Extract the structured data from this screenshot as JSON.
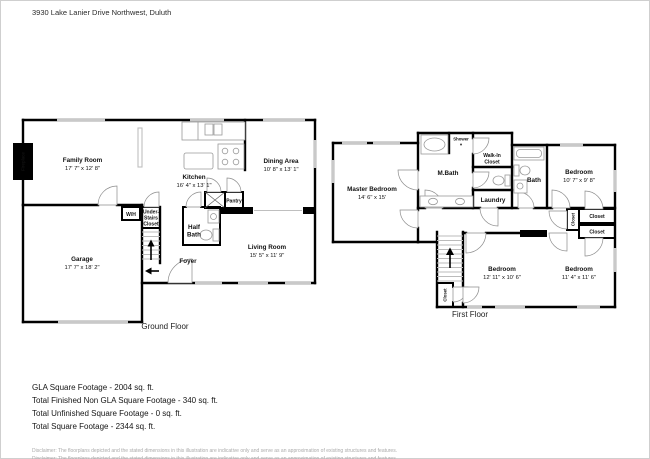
{
  "address": "3930 Lake Lanier Drive Northwest, Duluth",
  "ground_floor": {
    "caption": "Ground Floor",
    "family_room": {
      "name": "Family Room",
      "dims": "17' 7\" x 12' 8\""
    },
    "kitchen": {
      "name": "Kitchen",
      "dims": "16' 4\" x 13' 1\""
    },
    "dining_area": {
      "name": "Dining Area",
      "dims": "10' 8\" x 13' 1\""
    },
    "garage": {
      "name": "Garage",
      "dims": "17' 7\" x 18' 2\""
    },
    "living_room": {
      "name": "Living Room",
      "dims": "15' 5\" x 11' 9\""
    },
    "half_bath": {
      "line1": "Half",
      "line2": "Bath"
    },
    "foyer": "Foyer",
    "pantry": "Pantry",
    "wh": "W/H",
    "under_stairs_closet": {
      "line1": "Under-",
      "line2": "Stairs",
      "line3": "Closet"
    },
    "fireplace": "Fireplace"
  },
  "first_floor": {
    "caption": "First Floor",
    "master_bedroom": {
      "name": "Master Bedroom",
      "dims": "14' 6\" x 15'"
    },
    "m_bath": "M.Bath",
    "shower": "Shower",
    "walk_in_closet": {
      "line1": "Walk-In",
      "line2": "Closet"
    },
    "laundry": "Laundry",
    "bath": "Bath",
    "bedroom_top_right": {
      "name": "Bedroom",
      "dims": "10' 7\" x 9' 8\""
    },
    "bedroom_bottom_middle": {
      "name": "Bedroom",
      "dims": "12' 11\" x 10' 6\""
    },
    "bedroom_bottom_right": {
      "name": "Bedroom",
      "dims": "11' 4\" x 11' 6\""
    },
    "closet_hall_vertical": "Closet",
    "closet_top": "Closet",
    "closet_bottom": "Closet",
    "closet_stairs": "Closet"
  },
  "footage": {
    "line1": "GLA Square Footage - 2004 sq. ft.",
    "line2": "Total Finished Non GLA Square Footage - 340 sq. ft.",
    "line3": "Total Unfinished Square Footage - 0 sq. ft.",
    "line4": "Total Square Footage - 2344 sq. ft."
  },
  "disclaimer": "Disclaimer: The floorplans depicted and the stated dimensions in this illustration are indicative only and serve as an approximation of existing structures and features.",
  "colors": {
    "wall": "#000000",
    "window": "#c9c9c9",
    "fixture": "#9a9a9a",
    "door_arc": "#8c8c8c",
    "text": "#111111",
    "muted_text": "#aaaaaa"
  }
}
